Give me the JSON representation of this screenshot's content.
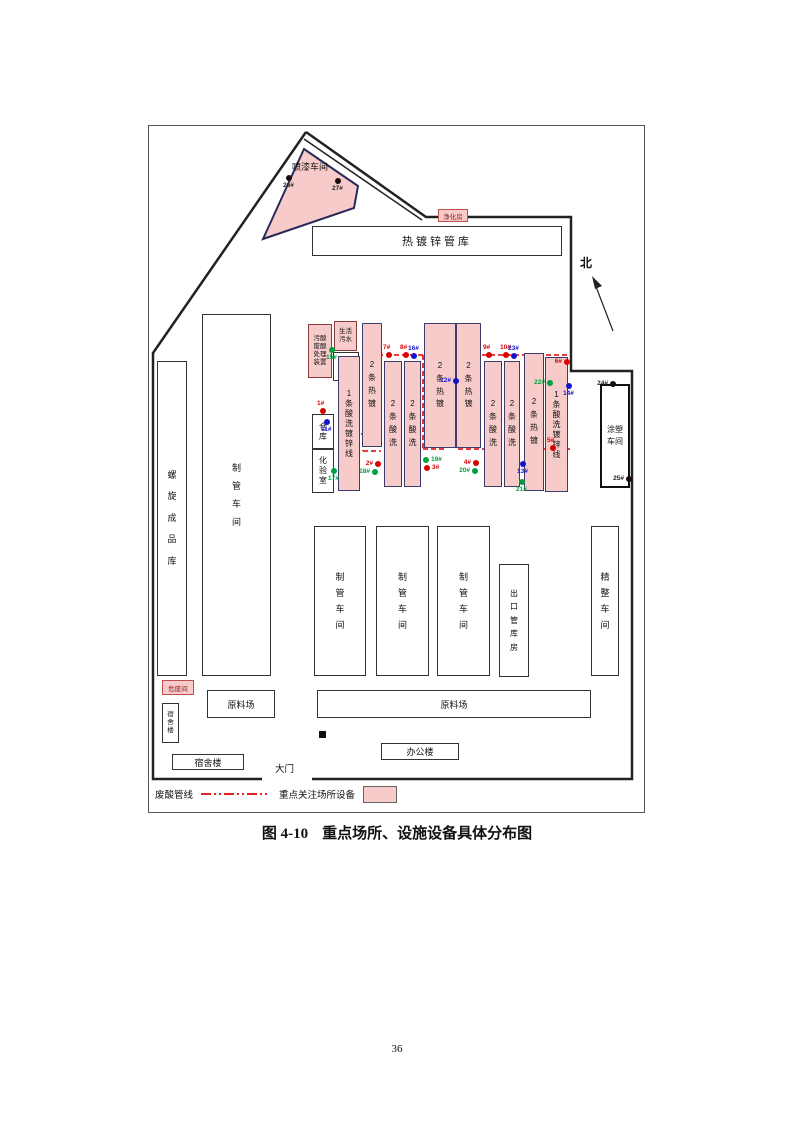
{
  "caption": {
    "fig_no": "图 4-10",
    "title": "重点场所、设施设备具体分布图"
  },
  "page": {
    "number": "36"
  },
  "compass": {
    "north_label": "北"
  },
  "legend": {
    "pipeline_label": "废酸管线",
    "key_sites_label": "重点关注场所设备",
    "pipeline_color": "#e10000",
    "key_site_fill": "#f8cbcb"
  },
  "buildings": {
    "paint_shop": "喷漆车间",
    "purify_room": "净化房",
    "galv_pipe_warehouse": "热镀锌管库",
    "spiral_product_warehouse": "螺旋成品库",
    "pipe_workshop_big": "制管车间",
    "acid_treatment_unit": "污酸废酸处理装置",
    "domestic_sewage": "生活污水",
    "wastewater_evaporation": "废水蒸发",
    "warehouse": "仓库",
    "laboratory": "化验室",
    "line1_galv_left": "1条酸洗镀锌线",
    "hot_galv_a": "2条热镀",
    "pickling_b": "2条酸洗",
    "pickling_c": "2条酸洗",
    "hot_galv_d": "2条热镀",
    "hot_galv_e": "2条热镀",
    "pickling_f": "2条酸洗",
    "pickling_g": "2条酸洗",
    "hot_galv_h": "2条热镀",
    "line1_galv_right": "1条酸洗镀锌线",
    "coating_workshop": "涂塑车间",
    "pipe_workshop_1": "制管车间",
    "pipe_workshop_2": "制管车间",
    "pipe_workshop_3": "制管车间",
    "export_pipe_warehouse": "出口管库房",
    "finishing_workshop": "精整车间",
    "raw_yard_left": "原料场",
    "raw_yard_right": "原料场",
    "office_building": "办公楼",
    "dormitory_vertical": "宿舍楼",
    "dormitory_horizontal": "宿舍楼",
    "hazardous_waste_room": "危废间",
    "gate": "大门"
  },
  "monitor_point_colors": {
    "red": "#d90000",
    "blue": "#1414cc",
    "green": "#00a040",
    "black": "#1a0a0a"
  },
  "dots": [
    {
      "label": "1#",
      "color": "red"
    },
    {
      "label": "2#",
      "color": "red"
    },
    {
      "label": "3#",
      "color": "red"
    },
    {
      "label": "4#",
      "color": "red"
    },
    {
      "label": "5#",
      "color": "red"
    },
    {
      "label": "6#",
      "color": "red"
    },
    {
      "label": "7#",
      "color": "red"
    },
    {
      "label": "8#",
      "color": "red"
    },
    {
      "label": "9#",
      "color": "red"
    },
    {
      "label": "10#",
      "color": "red"
    },
    {
      "label": "11#",
      "color": "blue"
    },
    {
      "label": "12#",
      "color": "blue"
    },
    {
      "label": "13#",
      "color": "blue"
    },
    {
      "label": "14#",
      "color": "blue"
    },
    {
      "label": "15#",
      "color": "green"
    },
    {
      "label": "16#",
      "color": "blue"
    },
    {
      "label": "17#",
      "color": "green"
    },
    {
      "label": "18#",
      "color": "green"
    },
    {
      "label": "19#",
      "color": "green"
    },
    {
      "label": "20#",
      "color": "green"
    },
    {
      "label": "21#",
      "color": "green"
    },
    {
      "label": "22#",
      "color": "green"
    },
    {
      "label": "23#",
      "color": "blue"
    },
    {
      "label": "24#",
      "color": "black"
    },
    {
      "label": "25#",
      "color": "black"
    },
    {
      "label": "26#",
      "color": "black"
    },
    {
      "label": "27#",
      "color": "black"
    }
  ]
}
